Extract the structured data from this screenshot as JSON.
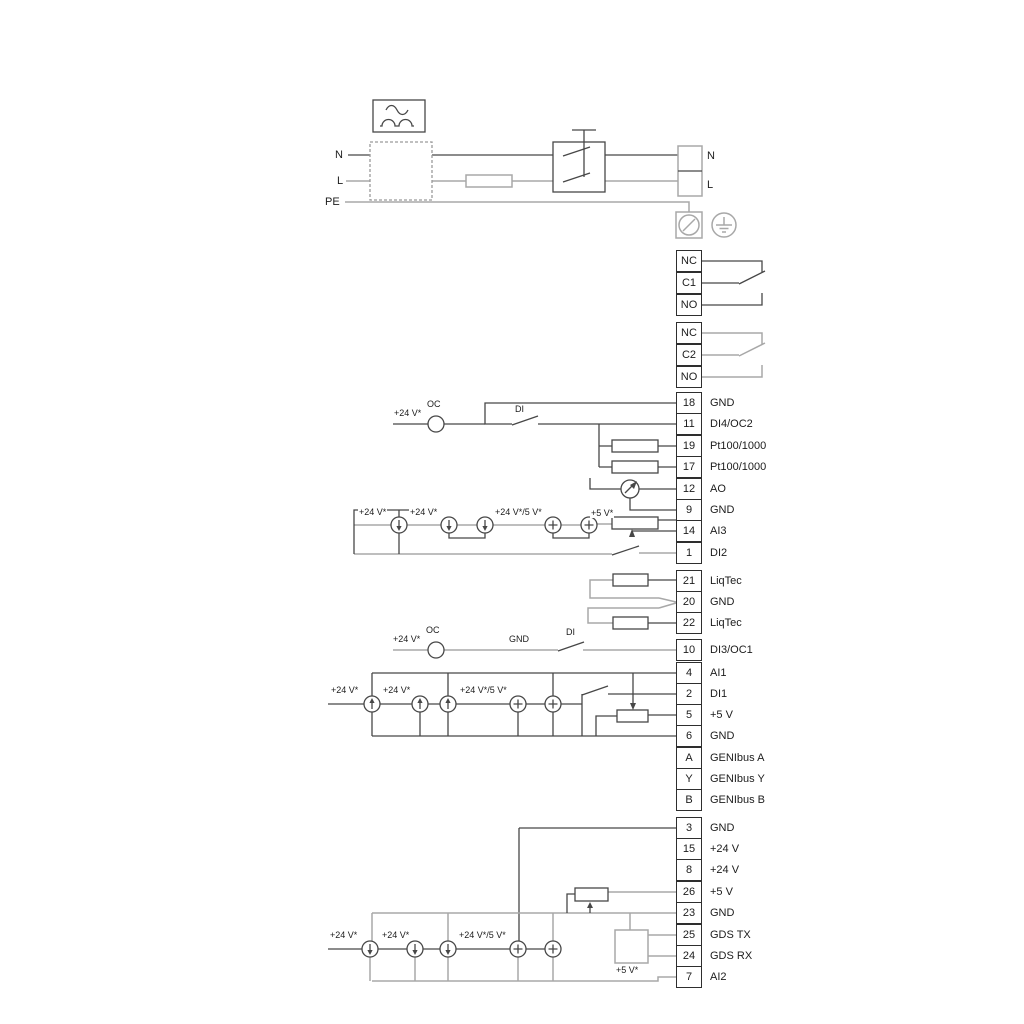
{
  "power": {
    "n_left": "N",
    "l_left": "L",
    "pe": "PE",
    "n_right": "N",
    "l_right": "L"
  },
  "relay1": [
    "NC",
    "C1",
    "NO"
  ],
  "relay2": [
    "NC",
    "C2",
    "NO"
  ],
  "groups": {
    "a": [
      {
        "id": "18",
        "label": "GND"
      },
      {
        "id": "11",
        "label": "DI4/OC2"
      },
      {
        "id": "19",
        "label": "Pt100/1000"
      },
      {
        "id": "17",
        "label": "Pt100/1000"
      },
      {
        "id": "12",
        "label": "AO"
      },
      {
        "id": "9",
        "label": "GND"
      },
      {
        "id": "14",
        "label": "AI3"
      },
      {
        "id": "1",
        "label": "DI2"
      }
    ],
    "b": [
      {
        "id": "21",
        "label": "LiqTec"
      },
      {
        "id": "20",
        "label": "GND"
      },
      {
        "id": "22",
        "label": "LiqTec"
      }
    ],
    "c": [
      {
        "id": "10",
        "label": "DI3/OC1"
      }
    ],
    "d": [
      {
        "id": "4",
        "label": "AI1"
      },
      {
        "id": "2",
        "label": "DI1"
      },
      {
        "id": "5",
        "label": "+5 V"
      },
      {
        "id": "6",
        "label": "GND"
      },
      {
        "id": "A",
        "label": "GENIbus A"
      },
      {
        "id": "Y",
        "label": "GENIbus Y"
      },
      {
        "id": "B",
        "label": "GENIbus B"
      }
    ],
    "e": [
      {
        "id": "3",
        "label": "GND"
      },
      {
        "id": "15",
        "label": "+24 V"
      },
      {
        "id": "8",
        "label": "+24 V"
      },
      {
        "id": "26",
        "label": "+5 V"
      },
      {
        "id": "23",
        "label": "GND"
      },
      {
        "id": "25",
        "label": "GDS TX"
      },
      {
        "id": "24",
        "label": "GDS RX"
      },
      {
        "id": "7",
        "label": "AI2"
      }
    ]
  },
  "annotations": {
    "oc2": {
      "v24": "+24 V*",
      "oc": "OC",
      "di": "DI"
    },
    "ai3": {
      "v24a": "+24 V*",
      "v24b": "+24 V*",
      "v245": "+24 V*/5 V*",
      "v5": "+5 V*"
    },
    "oc1": {
      "v24": "+24 V*",
      "oc": "OC",
      "gnd": "GND",
      "di": "DI"
    },
    "ai1": {
      "v24a": "+24 V*",
      "v24b": "+24 V*",
      "v245": "+24 V*/5 V*"
    },
    "ai2": {
      "v24a": "+24 V*",
      "v24b": "+24 V*",
      "v245": "+24 V*/5 V*",
      "v5": "+5 V*"
    }
  },
  "colors": {
    "line_dark": "#474747",
    "line_gray": "#a8a8a8",
    "text": "#1c1c1c",
    "terminal_border": "#2e2e2e"
  }
}
